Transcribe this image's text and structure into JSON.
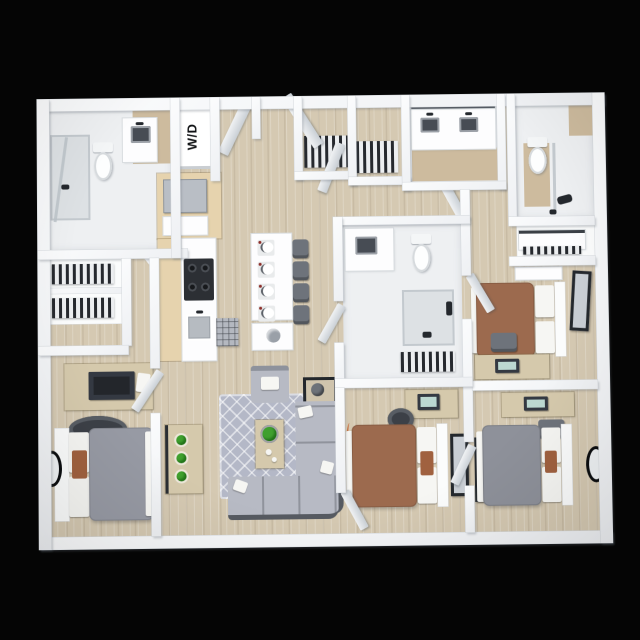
{
  "scene": {
    "type": "3d-floor-plan-render",
    "description": "Top-down 3D rendering of a four-bedroom, multi-bath apartment floor plan on a black background",
    "background_color": "#050505"
  },
  "labels": {
    "washer_dryer": "W/D"
  },
  "palette": {
    "background": "#050505",
    "wall": "#f8f9fa",
    "wood": "#d5c9b2",
    "tile": "#eef0f2",
    "bath_beige": "#cdbb9e",
    "cabinet_beige": "#e6d3ae",
    "rug_gray": "#b4b8c7",
    "sofa_gray": "#b7bac4",
    "bed_brown": "#9c6a4e",
    "bed_gray": "#8e919a",
    "duvet_gray": "#979aa4",
    "pillow_rust": "#a0613f",
    "desk_tan": "#d5c9ac",
    "monitor_dark": "#343942",
    "screen_teal": "#bcd8d1",
    "chair_slate": "#6e737b",
    "plant_green": "#3fa02e",
    "frame_dark": "#24282d"
  },
  "rooms": [
    "bathroom-top-left",
    "closet-left",
    "bedroom-bottom-left",
    "kitchen",
    "laundry-closet",
    "entry-hall",
    "hall-closet-1",
    "hall-closet-2",
    "bathroom-double-vanity",
    "bathroom-top-right",
    "dresser-closet",
    "bathroom-center",
    "bedroom-top-right",
    "bedroom-bottom-center",
    "bedroom-bottom-right",
    "living-room",
    "dining-area"
  ],
  "furniture": [
    "toilet",
    "shower",
    "vanity-sink",
    "double-vanity",
    "washer-dryer-stack",
    "refrigerator",
    "stove",
    "kitchen-sink",
    "dining-table",
    "place-setting",
    "dining-chair",
    "ottoman",
    "sectional-sofa",
    "armchair",
    "coffee-table",
    "potted-plant",
    "side-table",
    "media-console",
    "area-rug",
    "bed",
    "pillow",
    "desk",
    "monitor",
    "desk-chair",
    "dresser",
    "hanging-clothes",
    "wall-mirror",
    "oval-mirror"
  ]
}
